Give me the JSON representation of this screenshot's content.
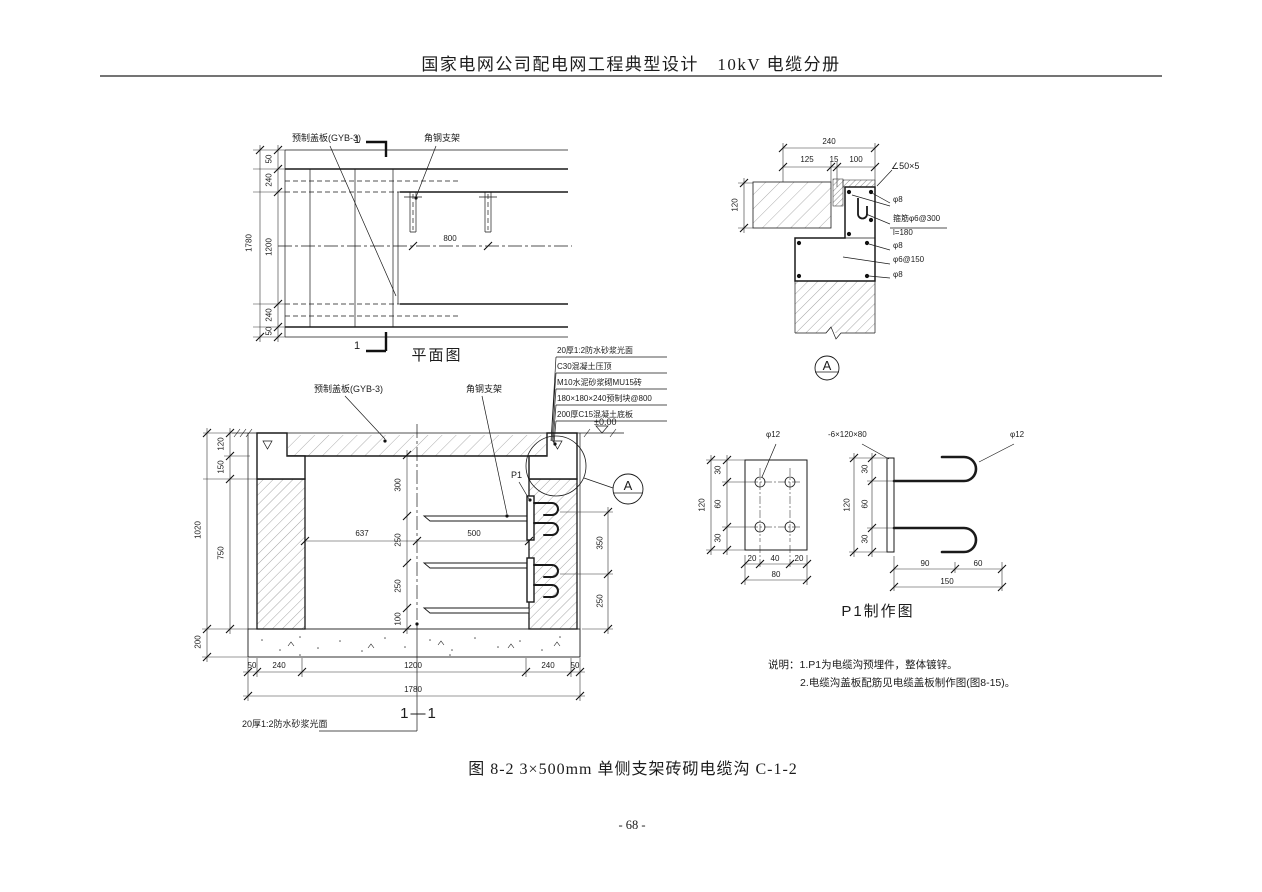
{
  "page": {
    "header_title": "国家电网公司配电网工程典型设计　10kV 电缆分册",
    "caption": "图 8-2 3×500mm 单侧支架砖砌电缆沟 C-1-2",
    "page_number": "- 68 -"
  },
  "plan_view": {
    "title": "平面图",
    "label_cover_plate": "预制盖板(GYB-3)",
    "label_bracket": "角钢支架",
    "section_mark": "1",
    "dims": {
      "edge_top": "50",
      "wall_top": "240",
      "trench": "1200",
      "wall_bottom": "240",
      "edge_bottom": "50",
      "total": "1780",
      "bracket_spacing": "800"
    }
  },
  "detail_a": {
    "bubble": "A",
    "labels": {
      "angle": "∠50×5",
      "rebar_top": "φ8",
      "stirrup": "箍筋φ6@300",
      "stirrup_length": "l=180",
      "rebar_mid": "φ8",
      "mesh": "φ6@150",
      "rebar_bottom": "φ8"
    },
    "dims": {
      "total_width": "240",
      "w_left": "125",
      "w_gap": "15",
      "w_right": "100",
      "height": "120"
    }
  },
  "section": {
    "title": "1—1",
    "labels": {
      "cover_plate": "预制盖板(GYB-3)",
      "bracket": "角钢支架",
      "p1": "P1",
      "level": "±0.00",
      "bubble": "A",
      "floor_finish": "20厚1:2防水砂浆光面"
    },
    "specs": [
      "20厚1:2防水砂浆光面",
      "C30混凝土压顶",
      "M10水泥砂浆砌MU15砖",
      "180×180×240预制块@800",
      "200厚C15混凝土底板"
    ],
    "dims": {
      "v300": "300",
      "v250a": "250",
      "v250b": "250",
      "v100": "100",
      "h637": "637",
      "h500": "500",
      "r350": "350",
      "r250": "250",
      "l120": "120",
      "l150": "150",
      "l750": "750",
      "l1020": "1020",
      "l200": "200",
      "b50l": "50",
      "b240l": "240",
      "b1200": "1200",
      "b240r": "240",
      "b50r": "50",
      "b1780": "1780"
    }
  },
  "p1_detail": {
    "title": "P1制作图",
    "labels": {
      "hole": "φ12",
      "plate": "-6×120×80",
      "rod": "φ12"
    },
    "front": {
      "v30a": "30",
      "v60": "60",
      "v30b": "30",
      "v120": "120",
      "h20a": "20",
      "h40": "40",
      "h20b": "20",
      "h80": "80"
    },
    "side": {
      "v30a": "30",
      "v60": "60",
      "v30b": "30",
      "v120": "120",
      "h90": "90",
      "h60": "60",
      "h150": "150"
    }
  },
  "notes": {
    "line1": "说明：1.P1为电缆沟预埋件，整体镀锌。",
    "line2": "2.电缆沟盖板配筋见电缆盖板制作图(图8-15)。"
  }
}
